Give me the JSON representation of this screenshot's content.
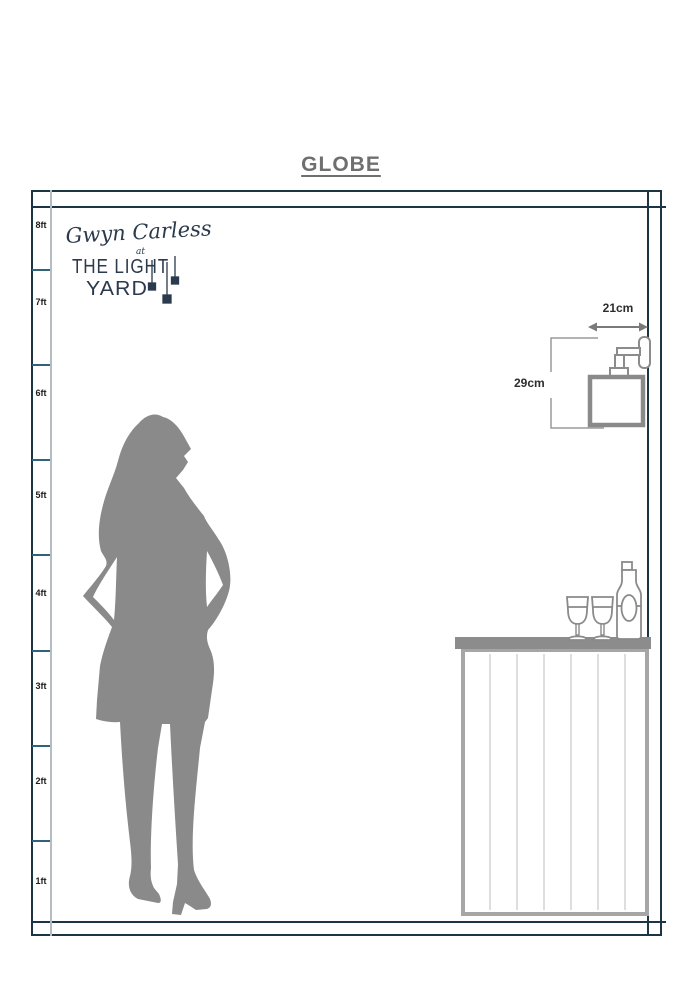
{
  "title": "GLOBE",
  "brand": {
    "script": "Gwyn Carless",
    "at": "at",
    "line1": "THE LIGHT",
    "line2": "YARD"
  },
  "ruler": {
    "unit": "ft",
    "labels": [
      "8ft",
      "7ft",
      "6ft",
      "5ft",
      "4ft",
      "3ft",
      "2ft",
      "1ft"
    ],
    "max_feet": 8
  },
  "fixture": {
    "name": "wall light",
    "width": "21cm",
    "height": "29cm"
  },
  "icons": [
    "pendant-light-icon",
    "wall-light-icon",
    "width-arrow-icon",
    "height-bracket-icon",
    "woman-silhouette-icon",
    "bar-counter-icon",
    "wine-glass-icon",
    "wine-bottle-icon"
  ],
  "colors": {
    "frame_navy": "#1c3545",
    "tick_teal": "#2f6375",
    "ruler_inner_line": "#b3bcc0",
    "title_gray": "#6f6f6f",
    "logo_navy": "#2b3a4d",
    "silhouette_gray": "#8a8a8a",
    "fixture_gray": "#8c8c8c",
    "counter_gray": "#8c8c8c",
    "counter_border": "#a6a6a6",
    "plank_gray": "#dedede",
    "dimension_text": "#2d2d2d"
  }
}
